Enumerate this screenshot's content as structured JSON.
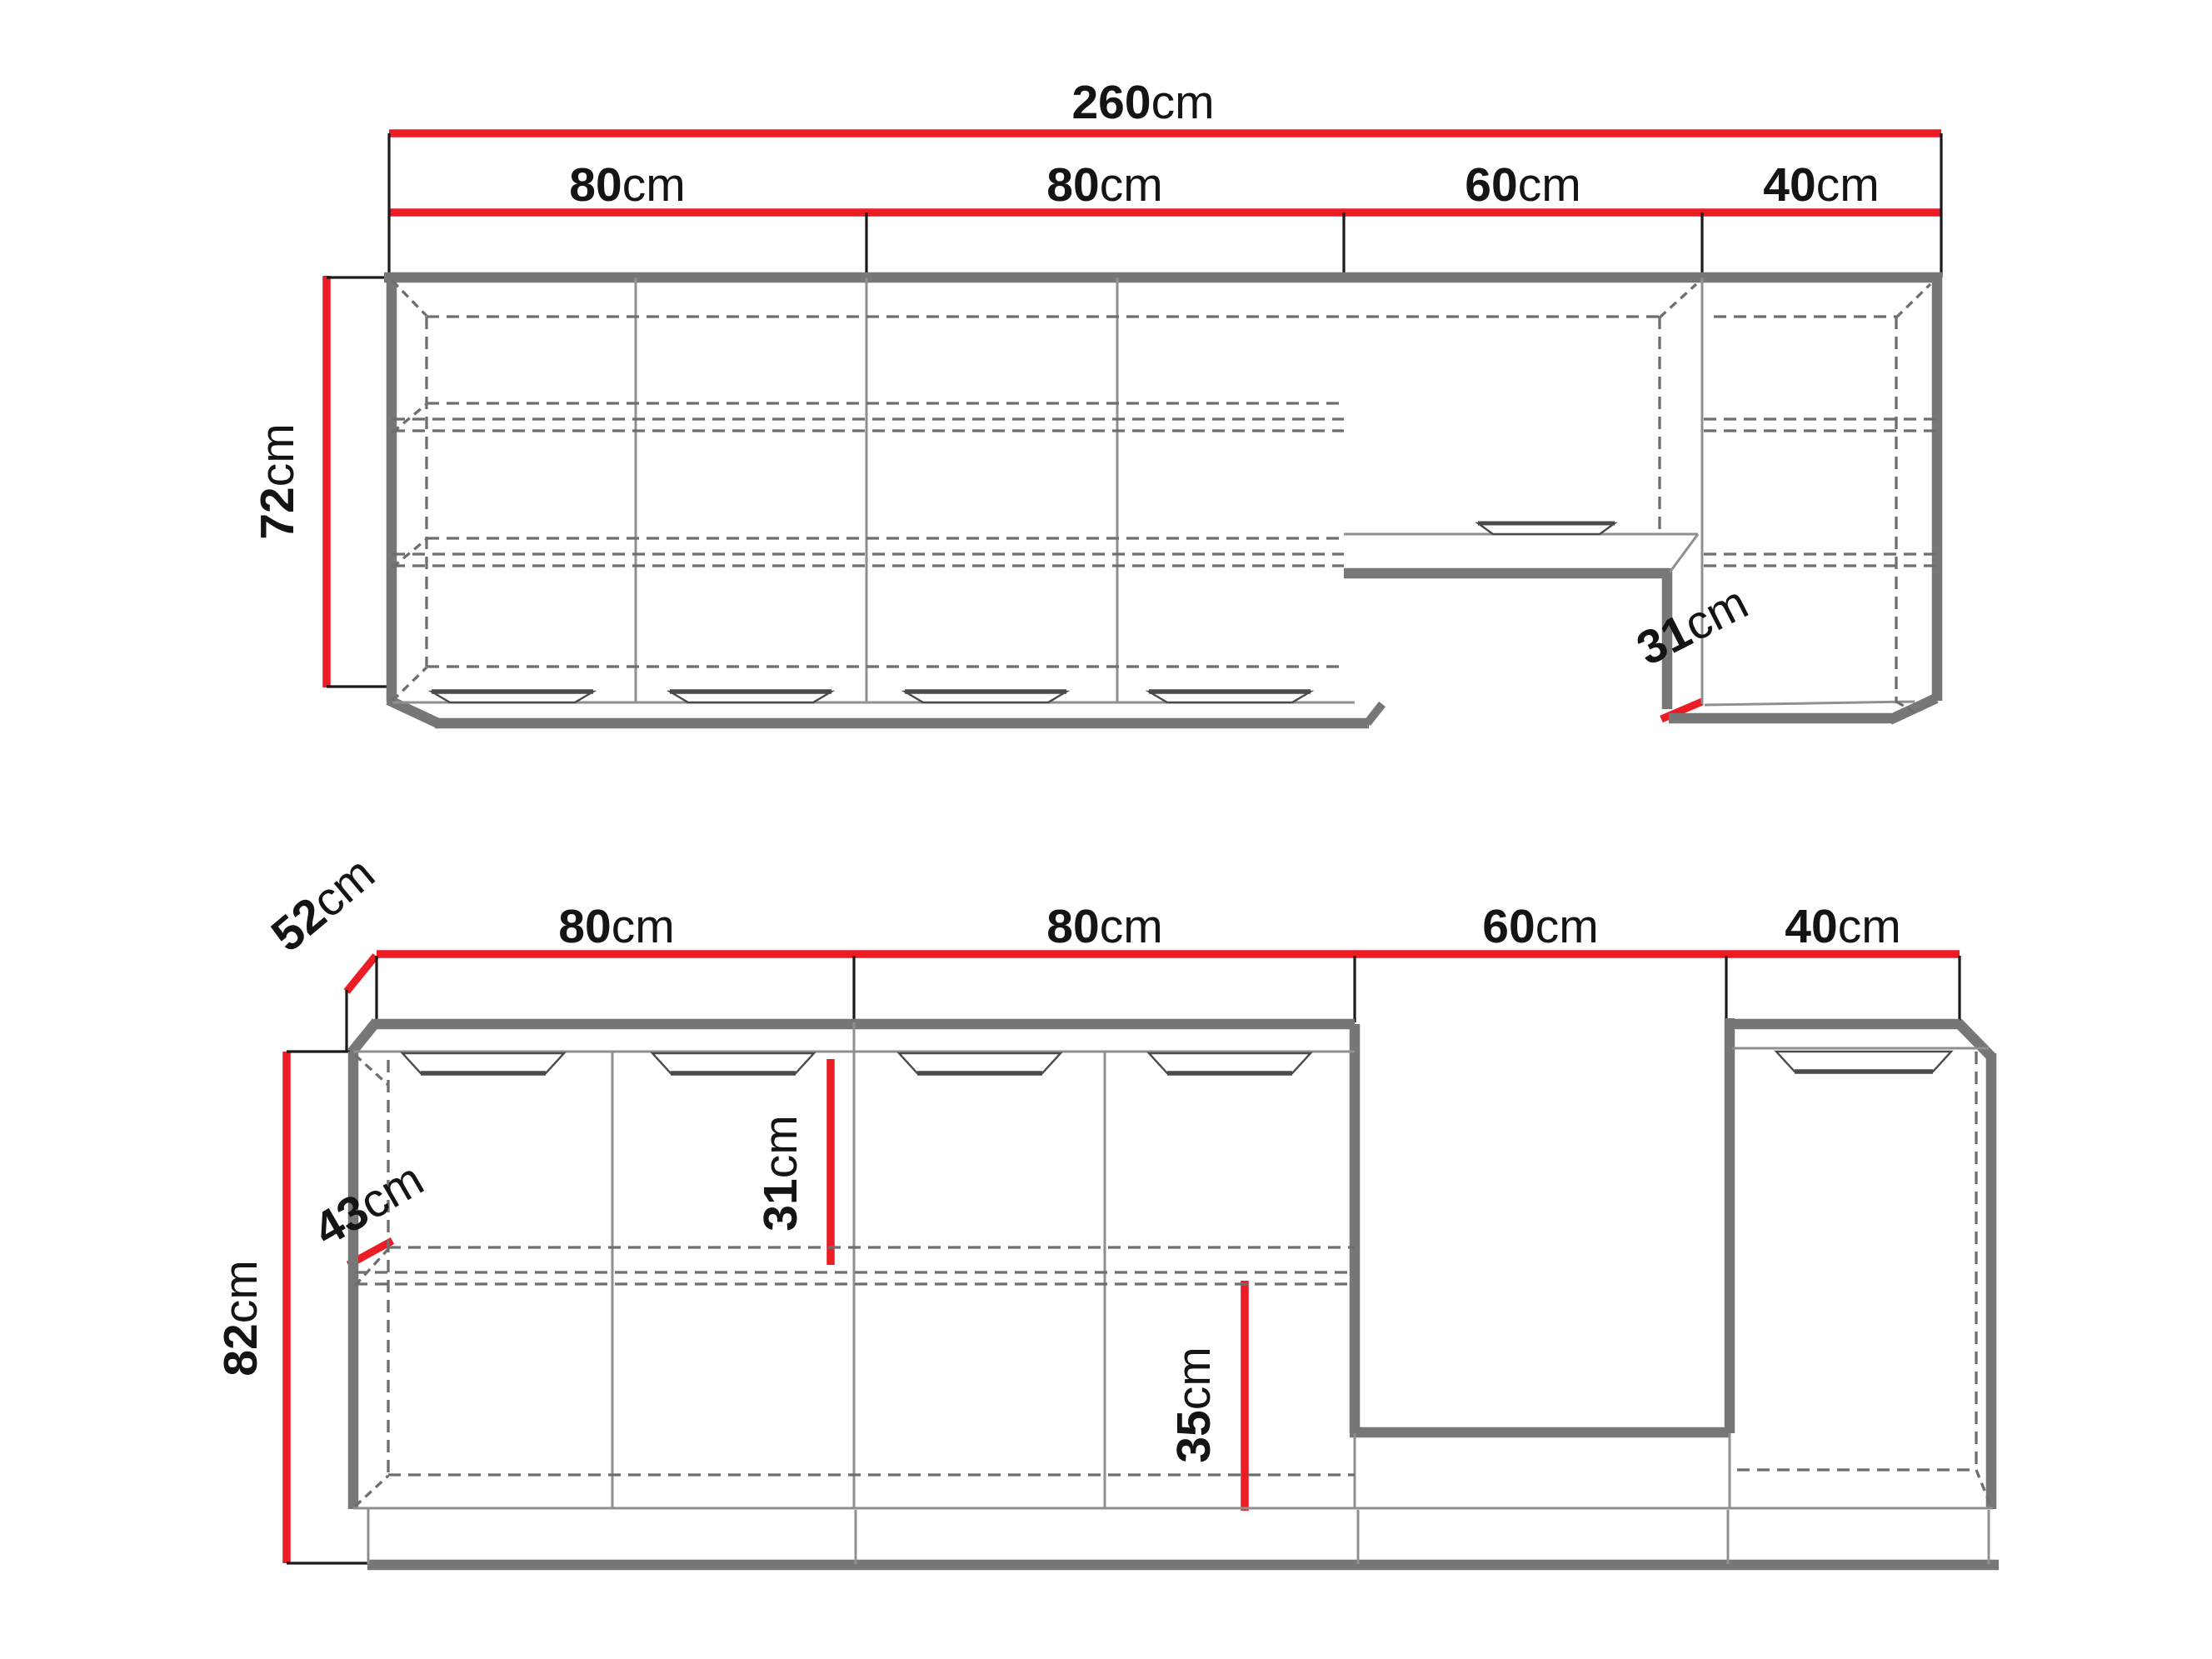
{
  "colors": {
    "dimension_red": "#EC1C24",
    "cabinet_gray": "#777777",
    "thin_line_gray": "#8F8F8F",
    "dashed_gray": "#6E6E6E",
    "extension_black": "#1A1A1A",
    "text_black": "#141414"
  },
  "upper_view": {
    "total_width": {
      "value": "260",
      "unit": "cm"
    },
    "segments": [
      {
        "value": "80",
        "unit": "cm"
      },
      {
        "value": "80",
        "unit": "cm"
      },
      {
        "value": "60",
        "unit": "cm"
      },
      {
        "value": "40",
        "unit": "cm"
      }
    ],
    "height": {
      "value": "72",
      "unit": "cm"
    },
    "depth": {
      "value": "31",
      "unit": "cm"
    }
  },
  "lower_view": {
    "segments": [
      {
        "value": "80",
        "unit": "cm"
      },
      {
        "value": "80",
        "unit": "cm"
      },
      {
        "value": "60",
        "unit": "cm"
      },
      {
        "value": "40",
        "unit": "cm"
      }
    ],
    "worktop_depth": {
      "value": "52",
      "unit": "cm"
    },
    "height": {
      "value": "82",
      "unit": "cm"
    },
    "body_depth": {
      "value": "43",
      "unit": "cm"
    },
    "upper_section_height": {
      "value": "31",
      "unit": "cm"
    },
    "lower_section_height": {
      "value": "35",
      "unit": "cm"
    }
  }
}
